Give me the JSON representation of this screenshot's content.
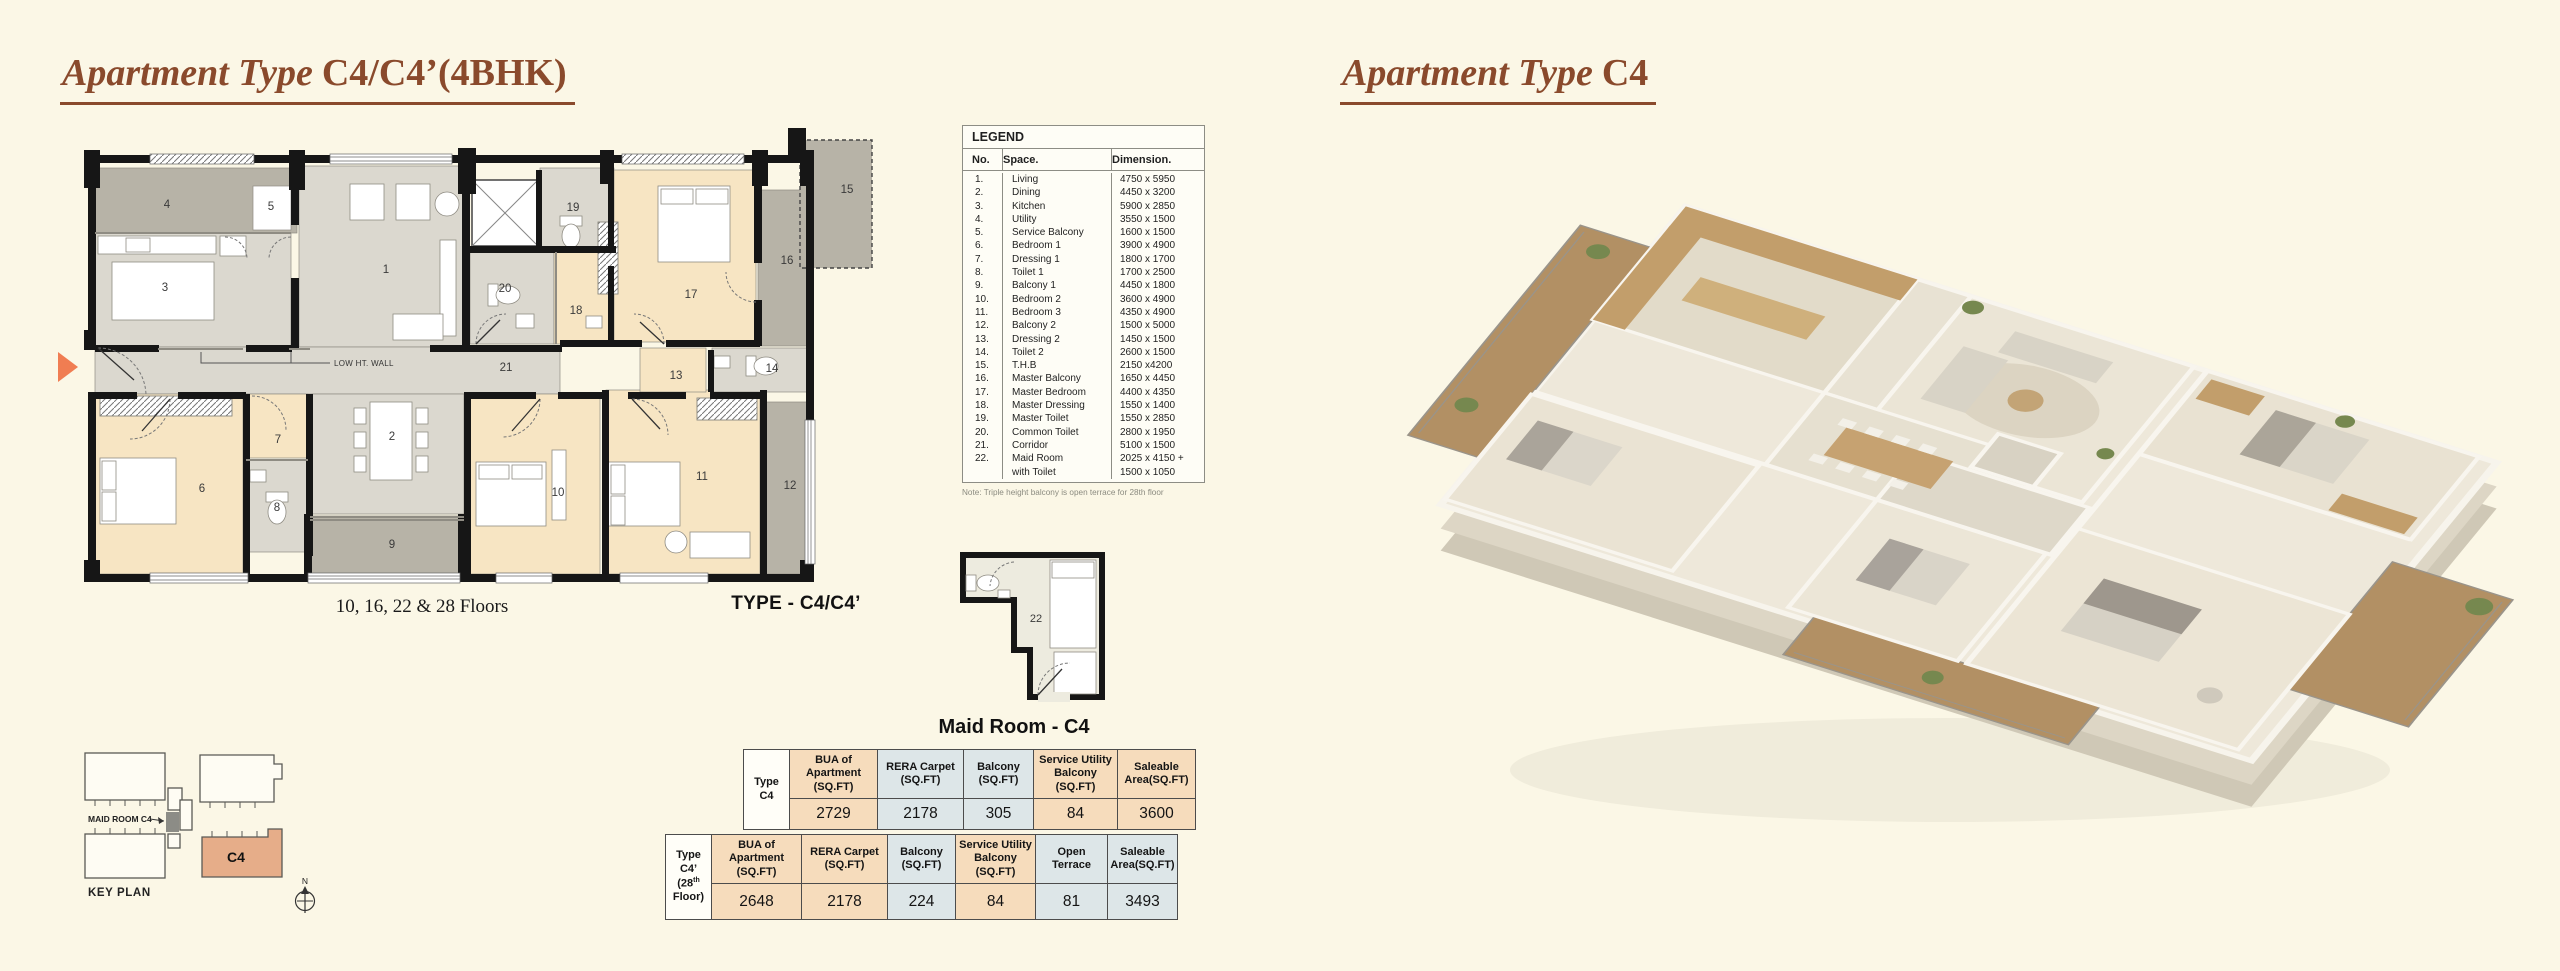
{
  "palette": {
    "page_bg": "#fbf7e6",
    "accent_brown": "#8a4a2c",
    "peach": "#f6dcbc",
    "blue": "#dde6e8",
    "arrow": "#f07d52",
    "keyplan_unit": "#e6ad89"
  },
  "titles": {
    "left_prefix": "Apartment Type",
    "left_code": "C4/C4’(4BHK)",
    "right_prefix": "Apartment Type",
    "right_code": "C4"
  },
  "floor_plan": {
    "low_wall_label": "LOW HT. WALL",
    "floors_label": "10, 16, 22 & 28 Floors",
    "type_label": "TYPE - C4/C4’",
    "rooms": [
      {
        "no": "1",
        "x": 386,
        "y": 273
      },
      {
        "no": "2",
        "x": 392,
        "y": 440
      },
      {
        "no": "3",
        "x": 165,
        "y": 291
      },
      {
        "no": "4",
        "x": 167,
        "y": 208
      },
      {
        "no": "5",
        "x": 271,
        "y": 210
      },
      {
        "no": "6",
        "x": 202,
        "y": 492
      },
      {
        "no": "7",
        "x": 278,
        "y": 443
      },
      {
        "no": "8",
        "x": 277,
        "y": 511
      },
      {
        "no": "9",
        "x": 392,
        "y": 548
      },
      {
        "no": "10",
        "x": 558,
        "y": 496
      },
      {
        "no": "11",
        "x": 702,
        "y": 480
      },
      {
        "no": "12",
        "x": 790,
        "y": 489
      },
      {
        "no": "13",
        "x": 676,
        "y": 379
      },
      {
        "no": "14",
        "x": 772,
        "y": 372
      },
      {
        "no": "15",
        "x": 847,
        "y": 193
      },
      {
        "no": "16",
        "x": 787,
        "y": 264
      },
      {
        "no": "17",
        "x": 691,
        "y": 298
      },
      {
        "no": "18",
        "x": 576,
        "y": 314
      },
      {
        "no": "19",
        "x": 573,
        "y": 211
      },
      {
        "no": "20",
        "x": 505,
        "y": 292
      },
      {
        "no": "21",
        "x": 506,
        "y": 371
      }
    ]
  },
  "legend": {
    "title": "LEGEND",
    "headers": [
      "No.",
      "Space.",
      "Dimension."
    ],
    "rows": [
      [
        "1.",
        "Living",
        "4750 x 5950"
      ],
      [
        "2.",
        "Dining",
        "4450 x 3200"
      ],
      [
        "3.",
        "Kitchen",
        "5900 x 2850"
      ],
      [
        "4.",
        "Utility",
        "3550 x 1500"
      ],
      [
        "5.",
        "Service Balcony",
        "1600 x 1500"
      ],
      [
        "6.",
        "Bedroom 1",
        "3900 x 4900"
      ],
      [
        "7.",
        "Dressing 1",
        "1800 x 1700"
      ],
      [
        "8.",
        "Toilet 1",
        "1700 x 2500"
      ],
      [
        "9.",
        "Balcony 1",
        "4450 x 1800"
      ],
      [
        "10.",
        "Bedroom 2",
        "3600 x 4900"
      ],
      [
        "11.",
        "Bedroom 3",
        "4350 x 4900"
      ],
      [
        "12.",
        "Balcony 2",
        "1500 x 5000"
      ],
      [
        "13.",
        "Dressing 2",
        "1450 x 1500"
      ],
      [
        "14.",
        "Toilet 2",
        "2600 x 1500"
      ],
      [
        "15.",
        "T.H.B",
        "2150 x4200"
      ],
      [
        "16.",
        "Master Balcony",
        "1650 x 4450"
      ],
      [
        "17.",
        "Master Bedroom",
        "4400 x 4350"
      ],
      [
        "18.",
        "Master Dressing",
        "1550 x 1400"
      ],
      [
        "19.",
        "Master Toilet",
        "1550 x 2850"
      ],
      [
        "20.",
        "Common Toilet",
        "2800 x 1950"
      ],
      [
        "21.",
        "Corridor",
        "5100 x 1500"
      ],
      [
        "22.",
        "Maid Room",
        "2025 x 4150 +"
      ],
      [
        "",
        "with Toilet",
        "1500 x 1050"
      ]
    ],
    "note": "Note: Triple height balcony is open terrace for 28th floor"
  },
  "maid_room": {
    "title": "Maid Room - C4",
    "room_number": "22"
  },
  "area_table_c4": {
    "row_header_lines": [
      "Type",
      "C4"
    ],
    "columns": [
      {
        "lines": [
          "BUA of",
          "Apartment",
          "(SQ.FT)"
        ],
        "tint": "peach",
        "value": "2729"
      },
      {
        "lines": [
          "RERA Carpet",
          "(SQ.FT)"
        ],
        "tint": "blue",
        "value": "2178"
      },
      {
        "lines": [
          "Balcony",
          "(SQ.FT)"
        ],
        "tint": "blue",
        "value": "305"
      },
      {
        "lines": [
          "Service Utility",
          "Balcony",
          "(SQ.FT)"
        ],
        "tint": "peach",
        "value": "84"
      },
      {
        "lines": [
          "Saleable",
          "Area(SQ.FT)"
        ],
        "tint": "peach",
        "value": "3600"
      }
    ]
  },
  "area_table_c4_28": {
    "row_header_lines": [
      "Type",
      "C4’",
      "(28th",
      "Floor)"
    ],
    "columns": [
      {
        "lines": [
          "BUA of",
          "Apartment",
          "(SQ.FT)"
        ],
        "tint": "peach",
        "value": "2648"
      },
      {
        "lines": [
          "RERA Carpet",
          "(SQ.FT)"
        ],
        "tint": "peach",
        "value": "2178"
      },
      {
        "lines": [
          "Balcony",
          "(SQ.FT)"
        ],
        "tint": "blue",
        "value": "224"
      },
      {
        "lines": [
          "Service Utility",
          "Balcony",
          "(SQ.FT)"
        ],
        "tint": "peach",
        "value": "84"
      },
      {
        "lines": [
          "Open",
          "Terrace"
        ],
        "tint": "blue",
        "value": "81"
      },
      {
        "lines": [
          "Saleable",
          "Area(SQ.FT)"
        ],
        "tint": "blue",
        "value": "3493"
      }
    ]
  },
  "key_plan": {
    "maid_label": "MAID ROOM C4",
    "unit_label": "C4",
    "title": "KEY PLAN",
    "north_label": "N"
  }
}
